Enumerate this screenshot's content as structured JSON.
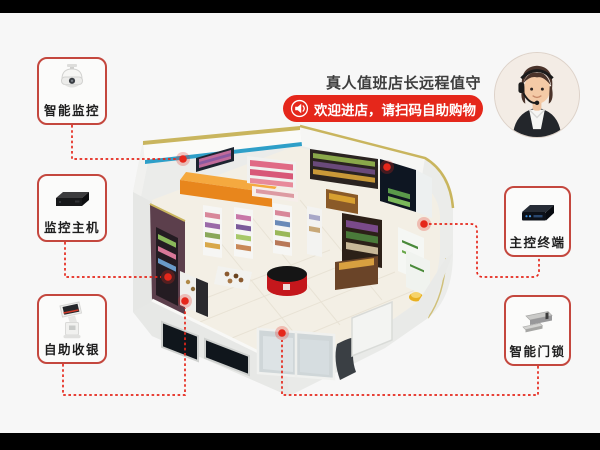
{
  "theme": {
    "background": "#f7f7f7",
    "letterbox": "#000000",
    "accent_red": "#e5271b",
    "label_border_red": "#c4473e",
    "ceiling_stripe_teal": "#2e9fc8",
    "wall_trim_gold": "#c9b55e"
  },
  "labels": {
    "left": [
      {
        "text": "智能监控",
        "icon": "dome-camera-icon"
      },
      {
        "text": "监控主机",
        "icon": "dvr-host-icon"
      },
      {
        "text": "自助收银",
        "icon": "checkout-kiosk-icon"
      }
    ],
    "right": [
      {
        "text": "主控终端",
        "icon": "control-terminal-icon"
      },
      {
        "text": "智能门锁",
        "icon": "magnetic-lock-icon"
      }
    ]
  },
  "callout": {
    "caption": "真人值班店长远程值守",
    "banner": {
      "text": "欢迎进店，请扫码自助购物",
      "icon": "speaker-icon",
      "color": "#e5271b"
    }
  },
  "center_illustration": "isometric-smart-store-render",
  "avatar": "store-manager-with-headset-photo"
}
